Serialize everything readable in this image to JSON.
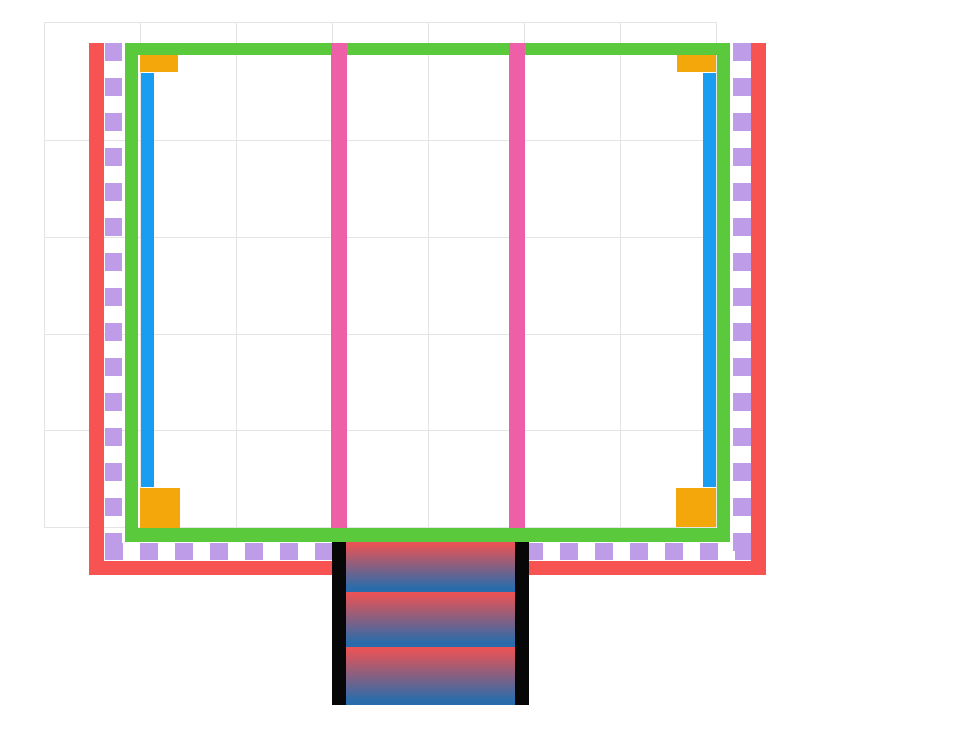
{
  "meta": {
    "description": "drawing-canvas diagram: rectangular plan with outer coral wall open at top, purple dashed inset line, green inner frame, blue side rails, orange corner pads, two pink vertical dividers, and a three-step gradient staircase with black stringers at bottom center",
    "canvas_width": 960,
    "canvas_height": 741,
    "background": "#ffffff"
  },
  "grid": {
    "color": "#e4e4e4",
    "thickness": 1,
    "x_lines": [
      44,
      140,
      236,
      332,
      428,
      524,
      620,
      716
    ],
    "y_lines": [
      22,
      140,
      237,
      334,
      430,
      527
    ],
    "x_min": 44,
    "x_max": 716,
    "y_min": 22,
    "y_max": 527
  },
  "palette": {
    "wall_red": "#f75353",
    "frame_green": "#5ac93c",
    "rail_blue": "#189df2",
    "divider_pink": "#ed5fa7",
    "dash_purple": "#bf9ce8",
    "corner_orange": "#f3a70b",
    "stair_black": "#070707",
    "stair_red": "#e75356",
    "stair_blue": "#2a6cab"
  },
  "shapes": [
    {
      "name": "outer-wall-left",
      "fill": "solid",
      "color": "wall_red",
      "x": 89,
      "y": 43,
      "w": 15,
      "h": 532
    },
    {
      "name": "outer-wall-right",
      "fill": "solid",
      "color": "wall_red",
      "x": 751,
      "y": 43,
      "w": 15,
      "h": 532
    },
    {
      "name": "outer-wall-bottom",
      "fill": "solid",
      "color": "wall_red",
      "x": 89,
      "y": 561,
      "w": 677,
      "h": 14
    },
    {
      "name": "dashed-line-left",
      "fill": "dash-v",
      "color": "dash_purple",
      "x": 105,
      "y": 43,
      "w": 17,
      "h": 517,
      "dash": 18,
      "gap": 17
    },
    {
      "name": "dashed-line-right",
      "fill": "dash-v",
      "color": "dash_purple",
      "x": 733,
      "y": 43,
      "w": 18,
      "h": 517,
      "dash": 18,
      "gap": 17
    },
    {
      "name": "dashed-line-bottom",
      "fill": "dash-h",
      "color": "dash_purple",
      "x": 105,
      "y": 543,
      "w": 646,
      "h": 17,
      "dash": 18,
      "gap": 17
    },
    {
      "name": "inner-frame-top",
      "fill": "solid",
      "color": "frame_green",
      "x": 125,
      "y": 43,
      "w": 605,
      "h": 12
    },
    {
      "name": "inner-frame-bottom",
      "fill": "solid",
      "color": "frame_green",
      "x": 125,
      "y": 528,
      "w": 605,
      "h": 14
    },
    {
      "name": "inner-frame-left",
      "fill": "solid",
      "color": "frame_green",
      "x": 125,
      "y": 43,
      "w": 13,
      "h": 499
    },
    {
      "name": "inner-frame-right",
      "fill": "solid",
      "color": "frame_green",
      "x": 717,
      "y": 43,
      "w": 13,
      "h": 499
    },
    {
      "name": "rail-left",
      "fill": "solid",
      "color": "rail_blue",
      "x": 141,
      "y": 73,
      "w": 13,
      "h": 414
    },
    {
      "name": "rail-right",
      "fill": "solid",
      "color": "rail_blue",
      "x": 703,
      "y": 73,
      "w": 13,
      "h": 414
    },
    {
      "name": "corner-pad-top-left",
      "fill": "solid",
      "color": "corner_orange",
      "x": 140,
      "y": 55,
      "w": 38,
      "h": 17
    },
    {
      "name": "corner-pad-top-right",
      "fill": "solid",
      "color": "corner_orange",
      "x": 677,
      "y": 55,
      "w": 39,
      "h": 17
    },
    {
      "name": "corner-pad-bottom-left",
      "fill": "solid",
      "color": "corner_orange",
      "x": 140,
      "y": 488,
      "w": 40,
      "h": 40
    },
    {
      "name": "corner-pad-bottom-right",
      "fill": "solid",
      "color": "corner_orange",
      "x": 676,
      "y": 488,
      "w": 40,
      "h": 39
    },
    {
      "name": "divider-left",
      "fill": "solid",
      "color": "divider_pink",
      "x": 331,
      "y": 43,
      "w": 16,
      "h": 485
    },
    {
      "name": "divider-right",
      "fill": "solid",
      "color": "divider_pink",
      "x": 509,
      "y": 43,
      "w": 16,
      "h": 485
    },
    {
      "name": "stair-stringer-left",
      "fill": "solid",
      "color": "stair_black",
      "x": 332,
      "y": 542,
      "w": 14,
      "h": 163
    },
    {
      "name": "stair-stringer-right",
      "fill": "solid",
      "color": "stair_black",
      "x": 515,
      "y": 542,
      "w": 14,
      "h": 163
    },
    {
      "name": "stair-step-1",
      "fill": "gradient-v",
      "color1": "stair_red",
      "color2": "stair_blue",
      "x": 346,
      "y": 542,
      "w": 169,
      "h": 50
    },
    {
      "name": "stair-step-2",
      "fill": "gradient-v",
      "color1": "stair_red",
      "color2": "stair_blue",
      "x": 346,
      "y": 592,
      "w": 169,
      "h": 55
    },
    {
      "name": "stair-step-3",
      "fill": "gradient-v",
      "color1": "stair_red",
      "color2": "stair_blue",
      "x": 346,
      "y": 647,
      "w": 169,
      "h": 58
    }
  ]
}
